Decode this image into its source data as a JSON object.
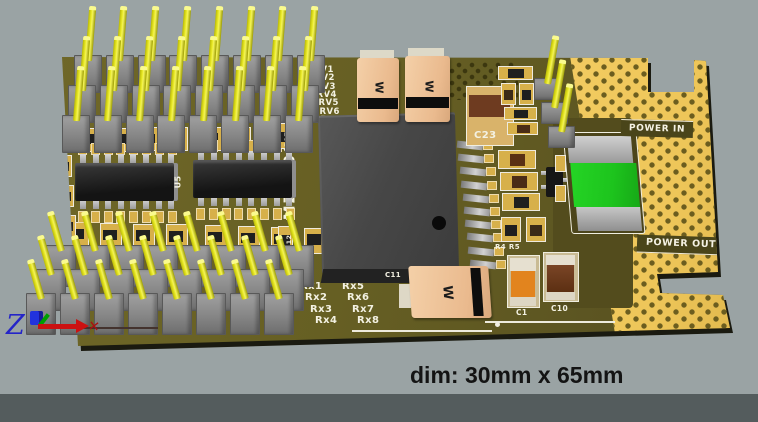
{
  "viewport": {
    "caption": "dim: 30mm x 65mm",
    "background_color": "#9aa3a4"
  },
  "axis_triad": {
    "z_label": "Z",
    "x_marker": "✕"
  },
  "pcb": {
    "part_number": "LMZ12008",
    "servo_labels": [
      "SRV1",
      "SRV2",
      "SRV3",
      "SRV4",
      "SRV5",
      "SRV6",
      "SRV7"
    ],
    "rx_labels": [
      [
        "Rx1",
        "Rx2",
        "Rx3",
        "Rx4"
      ],
      [
        "Rx5",
        "Rx6",
        "Rx7",
        "Rx8"
      ]
    ],
    "power_in_label": "POWER IN",
    "power_out_label": "POWER OUT",
    "designators": {
      "c23": "C23",
      "c11": "C11",
      "c1": "C1",
      "c10": "C10",
      "r45": "R4 R5",
      "u4": "U4",
      "u5": "U5",
      "r17": "R17",
      "r12": "R12"
    },
    "cap_marking": "W",
    "headers": {
      "top_left": {
        "rows": 3,
        "cols": 8
      },
      "bottom_left": {
        "rows": 3,
        "cols": 8
      },
      "top_right": {
        "rows": 3,
        "cols": 1
      }
    },
    "colors": {
      "gold": "#eec659",
      "substrate": "#665f23",
      "pin_yellow": "#e2e21e",
      "fuse_green": "#1dc41d",
      "cap_orange": "#e2841e"
    }
  }
}
